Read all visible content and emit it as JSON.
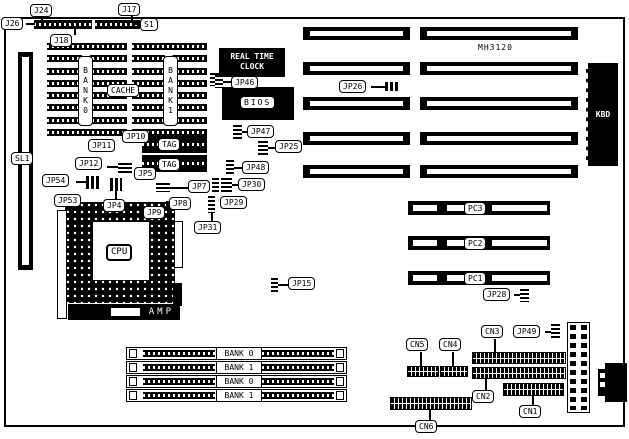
{
  "board": {
    "model": "MH3120"
  },
  "labels": {
    "j24": "J24",
    "j17": "J17",
    "j26": "J26",
    "s1": "S1",
    "j18": "J18",
    "sl1": "SL1",
    "cache": "CACHE",
    "cache_bank0": "BANK0",
    "cache_bank1": "BANK1",
    "tag_upper": "TAG",
    "tag_lower": "TAG",
    "rtc": "REAL TIME\nCLOCK",
    "bios": "BIOS",
    "cpu": "CPU",
    "amp": "AMP",
    "kbd": "KBD",
    "jp4": "JP4",
    "jp5": "JP5",
    "jp7": "JP7",
    "jp8": "JP8",
    "jp9": "JP9",
    "jp10": "JP10",
    "jp11": "JP11",
    "jp12": "JP12",
    "jp15": "JP15",
    "jp25": "JP25",
    "jp26": "JP26",
    "jp28": "JP28",
    "jp29": "JP29",
    "jp30": "JP30",
    "jp31": "JP31",
    "jp46": "JP46",
    "jp47": "JP47",
    "jp48": "JP48",
    "jp49": "JP49",
    "jp53": "JP53",
    "jp54": "JP54",
    "pc1": "PC1",
    "pc2": "PC2",
    "pc3": "PC3",
    "cn1": "CN1",
    "cn2": "CN2",
    "cn3": "CN3",
    "cn4": "CN4",
    "cn5": "CN5",
    "cn6": "CN6"
  },
  "simm_slots": [
    {
      "label": "BANK 0"
    },
    {
      "label": "BANK 1"
    },
    {
      "label": "BANK 0"
    },
    {
      "label": "BANK 1"
    }
  ]
}
